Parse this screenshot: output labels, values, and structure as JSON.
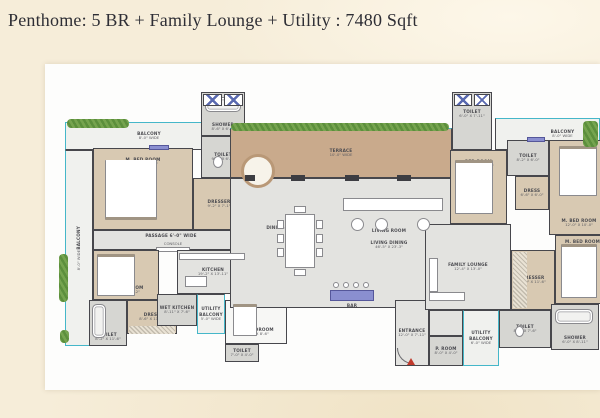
{
  "title": "Penthome: 5 BR + Family Lounge + Utility : 7480 Sqft",
  "colors": {
    "page_bg": "#f6edd9",
    "sheet": "#fdfdfc",
    "wall": "#47474c",
    "bedroom_floor": "#d8c9b2",
    "common_floor": "#e3e3e0",
    "wet_floor": "#d6d6d2",
    "terrace_floor": "#c9aa8c",
    "balcony_floor": "#f0f1ee",
    "plant_green": "#6b9e45",
    "railing_teal": "#45b7c9",
    "accent_purple": "#8a8fd0",
    "entry_red": "#c0392b",
    "title_text": "#2e2e35"
  },
  "plan": {
    "rooms": {
      "balcony_top_left": {
        "label": "BALCONY",
        "dims": "8'-0\" WIDE"
      },
      "balcony_left": {
        "label": "BALCONY",
        "dims": "8'-0\" WIDE"
      },
      "m_bed_1": {
        "label": "M. BED ROOM",
        "dims": "21'-8\" X 13'-11\""
      },
      "shower_1": {
        "label": "SHOWER",
        "dims": "8'-6\" X 6'-0\""
      },
      "toilet_1": {
        "label": "TOILET",
        "dims": "9'-2\" X 6'-0\""
      },
      "dresser_1": {
        "label": "DRESSER",
        "dims": "9'-2\" X 7'-1\""
      },
      "passage": {
        "label": "PASSAGE 6'-0\" WIDE"
      },
      "console": {
        "label": "CONSOLE"
      },
      "m_bed_2": {
        "label": "M. BED ROOM",
        "dims": "12'-6\" X 17'-2\""
      },
      "dress_2": {
        "label": "DRESS",
        "dims": "8'-6\" X 11'-6\""
      },
      "toilet_2": {
        "label": "TOILET",
        "dims": "8'-2\" X 11'-6\""
      },
      "kitchen": {
        "label": "KITCHEN",
        "dims": "19'-2\" X 13'-11\""
      },
      "wet_kitchen": {
        "label": "WET KITCHEN",
        "dims": "8'-11\" X 7'-6\""
      },
      "utility_balcony_left": {
        "label": "UTILITY BALCONY",
        "dims": "5'-0\" WIDE"
      },
      "uti_bedroom": {
        "label": "UTI/BEDROOM",
        "dims": "13'-6\" X 8'-6\""
      },
      "toilet_3": {
        "label": "TOILET",
        "dims": "7'-0\" X 4'-0\""
      },
      "terrace": {
        "label": "TERRACE",
        "dims": "10'-0\" WIDE"
      },
      "dining_area": {
        "label": "DINING AREA"
      },
      "living_room": {
        "label": "LIVING ROOM"
      },
      "living_dining": {
        "label": "LIVING DINING",
        "dims": "46'-5\" X 23'-3\""
      },
      "bar": {
        "label": "BAR"
      },
      "entrance": {
        "label": "ENTRANCE",
        "dims": "12'-0\" X 7'-11\""
      },
      "toilet_4": {
        "label": "TOILET",
        "dims": "6'-0\" X 7'-11\""
      },
      "bedroom_3": {
        "label": "BED ROOM",
        "dims": "11'-11\" X 10'-3\""
      },
      "balcony_top_right": {
        "label": "BALCONY",
        "dims": "8'-0\" WIDE"
      },
      "toilet_5": {
        "label": "TOILET",
        "dims": "8'-2\" X 6'-0\""
      },
      "dress_3": {
        "label": "DRESS",
        "dims": "6'-6\" X 6'-0\""
      },
      "m_bed_4": {
        "label": "M. BED ROOM",
        "dims": "12'-0\" X 10'-0\""
      },
      "m_bed_5": {
        "label": "M. BED ROOM",
        "dims": "21'-2\" X 13'-0\""
      },
      "family_lounge": {
        "label": "FAMILY LOUNGE",
        "dims": "12'-4\" X 13'-0\""
      },
      "dresser_4": {
        "label": "DRESSER",
        "dims": "8'-0\" X 11'-6\""
      },
      "toilet_6": {
        "label": "TOILET",
        "dims": "8'-6\" X 7'-6\""
      },
      "shower_2": {
        "label": "SHOWER",
        "dims": "6'-0\" X 8'-11\""
      },
      "utility_balcony_right": {
        "label": "UTILITY BALCONY",
        "dims": "6'-0\" WIDE"
      },
      "p_room": {
        "label": "P. ROOM",
        "dims": "8'-0\" X 4'-0\""
      }
    }
  }
}
